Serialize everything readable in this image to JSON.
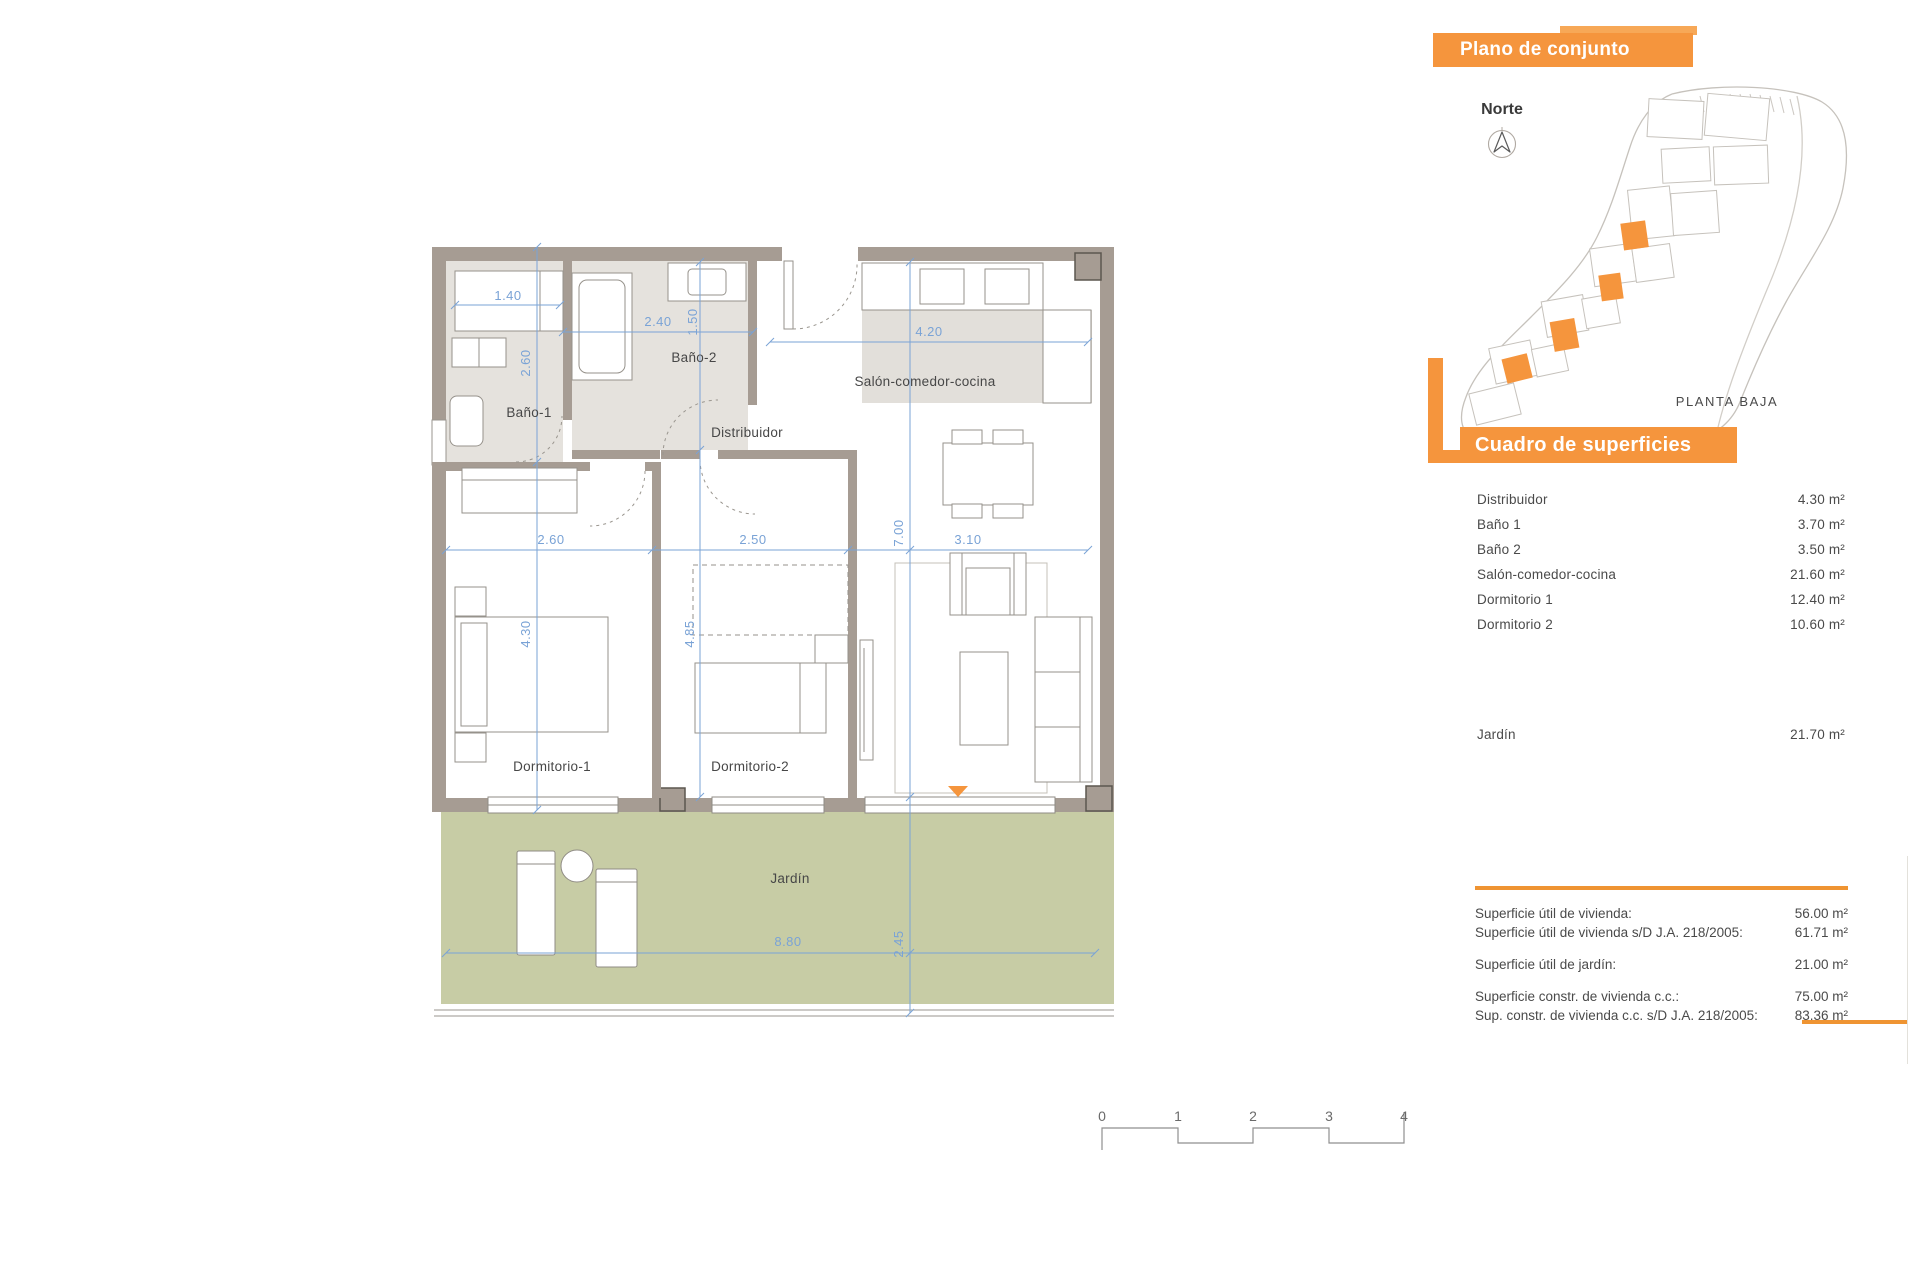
{
  "panels": {
    "plano": {
      "title": "Plano de conjunto",
      "norte": "Norte",
      "planta": "PLANTA BAJA"
    },
    "cuadro": {
      "title": "Cuadro de superficies",
      "rows": [
        {
          "label": "Distribuidor",
          "value": "4.30 m²"
        },
        {
          "label": "Baño 1",
          "value": "3.70 m²"
        },
        {
          "label": "Baño 2",
          "value": "3.50 m²"
        },
        {
          "label": "Salón-comedor-cocina",
          "value": "21.60 m²"
        },
        {
          "label": "Dormitorio 1",
          "value": "12.40 m²"
        },
        {
          "label": "Dormitorio 2",
          "value": "10.60 m²"
        }
      ],
      "jardin_row": {
        "label": "Jardín",
        "value": "21.70 m²"
      }
    },
    "summary": {
      "rows": [
        {
          "label": "Superficie útil de vivienda:",
          "value": "56.00 m²"
        },
        {
          "label": "Superficie útil de vivienda s/D J.A. 218/2005:",
          "value": "61.71 m²"
        },
        {
          "label": "Superficie útil de jardín:",
          "value": "21.00 m²"
        },
        {
          "label": "Superficie constr. de vivienda c.c.:",
          "value": "75.00 m²"
        },
        {
          "label": "Sup. constr. de vivienda c.c. s/D J.A. 218/2005:",
          "value": "83.36 m²"
        }
      ]
    }
  },
  "plan": {
    "labels": {
      "bano1": "Baño-1",
      "bano2": "Baño-2",
      "distribuidor": "Distribuidor",
      "salon": "Salón-comedor-cocina",
      "dorm1": "Dormitorio-1",
      "dorm2": "Dormitorio-2",
      "jardin": "Jardín"
    },
    "dims": {
      "closet_w": "1.40",
      "bano1_h": "2.60",
      "bano2_w": "2.40",
      "bano2_h": "1.50",
      "salon_top_w": "4.20",
      "dorm1_w": "2.60",
      "dorm2_w": "2.50",
      "salon_w": "3.10",
      "salon_h": "7.00",
      "dorm1_h": "4.30",
      "dorm2_h": "4.85",
      "jardin_h": "2.45",
      "jardin_w": "8.80"
    }
  },
  "scale_bar": {
    "ticks": [
      "0",
      "1",
      "2",
      "3",
      "4"
    ]
  },
  "colors": {
    "accent_orange": "#f5953d",
    "dimension_blue": "#7aa3d6",
    "wall_taupe": "#a69c93",
    "garden_green": "#c7cca5",
    "bath_floor": "#e5e2dd"
  }
}
